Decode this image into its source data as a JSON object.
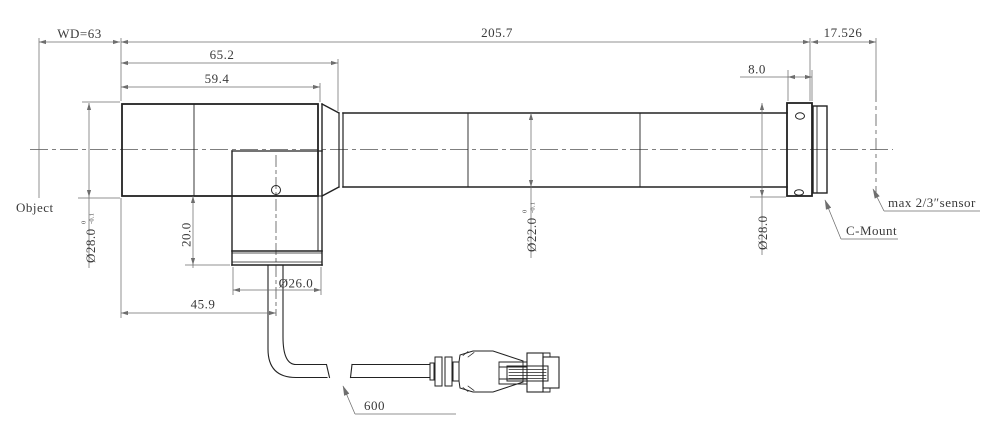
{
  "drawing": {
    "dims": {
      "wd": "WD=63",
      "length_total": "205.7",
      "flange_focal": "17.526",
      "front_outer": "65.2",
      "front": "59.4",
      "mount_width": "8.0",
      "front_dia": "Ø28.0",
      "front_dia_tol_up": "0",
      "front_dia_tol_dn": "-0.1",
      "body_drop": "20.0",
      "body_dia": "Ø26.0",
      "cable_offset": "45.9",
      "barrel_dia": "Ø22.0",
      "barrel_dia_tol_up": "0",
      "barrel_dia_tol_dn": "-0.1",
      "mount_dia": "Ø28.0",
      "cable_length": "600"
    },
    "labels": {
      "object_plane": "Object",
      "sensor": "max 2/3″sensor",
      "mount": "C-Mount"
    },
    "colors": {
      "outline": "#222222",
      "dimension": "#6e6e6e",
      "text": "#3a3a3a",
      "background": "#ffffff"
    }
  }
}
